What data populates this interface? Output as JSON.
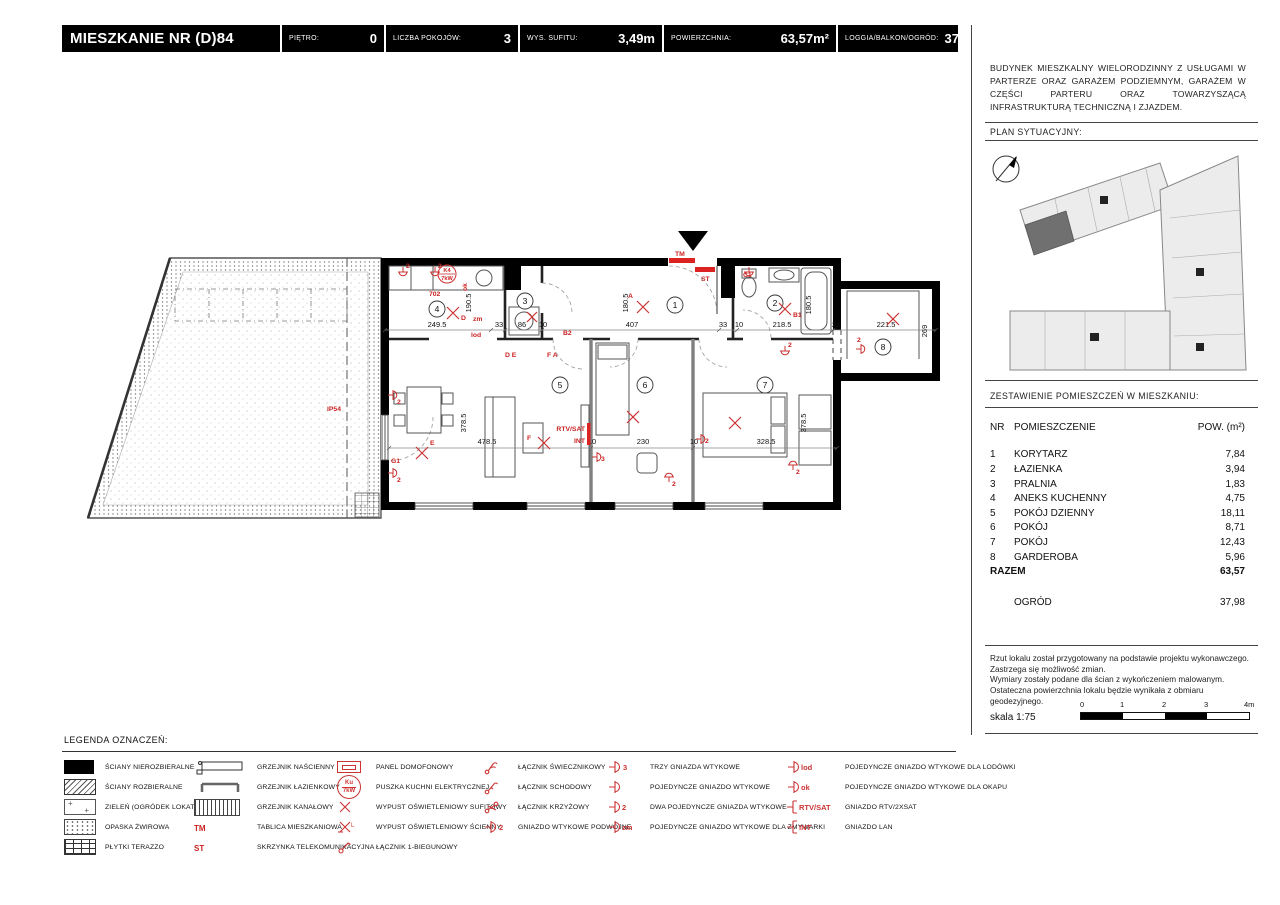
{
  "header": {
    "title": "MIESZKANIE NR (D)84",
    "fields": [
      {
        "label": "PIĘTRO:",
        "value": "0"
      },
      {
        "label": "LICZBA POKOJÓW:",
        "value": "3"
      },
      {
        "label": "WYS. SUFITU:",
        "value": "3,49m"
      },
      {
        "label": "POWIERZCHNIA:",
        "value": "63,57m²"
      },
      {
        "label": "LOGGIA/BALKON/OGRÓD:",
        "value": "37,98m²"
      }
    ]
  },
  "sidebar": {
    "description": "BUDYNEK MIESZKALNY WIELORODZINNY Z USŁUGAMI W PARTERZE ORAZ GARAŻEM PODZIEMNYM, GARAŻEM W CZĘŚCI PARTERU ORAZ TOWARZYSZĄCĄ INFRASTRUKTURĄ TECHNICZNĄ I ZJAZDEM.",
    "plan_sytuacyjny_label": "PLAN SYTUACYJNY:",
    "table_title": "ZESTAWIENIE POMIESZCZEŃ W MIESZKANIU:",
    "table": {
      "col_nr": "NR",
      "col_name": "POMIESZCZENIE",
      "col_area": "POW. (m²)",
      "rows": [
        {
          "nr": "1",
          "name": "KORYTARZ",
          "area": "7,84"
        },
        {
          "nr": "2",
          "name": "ŁAZIENKA",
          "area": "3,94"
        },
        {
          "nr": "3",
          "name": "PRALNIA",
          "area": "1,83"
        },
        {
          "nr": "4",
          "name": "ANEKS KUCHENNY",
          "area": "4,75"
        },
        {
          "nr": "5",
          "name": "POKÓJ DZIENNY",
          "area": "18,11"
        },
        {
          "nr": "6",
          "name": "POKÓJ",
          "area": "8,71"
        },
        {
          "nr": "7",
          "name": "POKÓJ",
          "area": "12,43"
        },
        {
          "nr": "8",
          "name": "GARDEROBA",
          "area": "5,96"
        }
      ],
      "total_label": "RAZEM",
      "total": "63,57",
      "garden_label": "OGRÓD",
      "garden": "37,98"
    },
    "disclaimer": [
      "Rzut lokalu został przygotowany na podstawie projektu wykonawczego.",
      "Zastrzega się możliwość zmian.",
      "Wymiary zostały podane dla ścian z wykończeniem malowanym.",
      "Ostateczna powierzchnia lokalu będzie wynikała z obmiaru",
      "geodezyjnego."
    ],
    "scale_label": "skala 1:75",
    "scale_ticks": [
      "0",
      "1",
      "2",
      "3",
      "4m"
    ]
  },
  "plan": {
    "rooms": [
      "1",
      "2",
      "3",
      "4",
      "5",
      "6",
      "7",
      "8"
    ],
    "dims_top": [
      "249.5",
      "33",
      "86",
      "10",
      "407",
      "33",
      "10",
      "218.5",
      "21",
      "221.5"
    ],
    "dims_side": [
      "190.5",
      "180.5",
      "180.5",
      "269"
    ],
    "dims_bottom": [
      "478.5",
      "10",
      "230",
      "10",
      "328.5"
    ],
    "dims_side2": [
      "378.5",
      "378.5"
    ],
    "marks": {
      "tm": "TM",
      "st": "ST",
      "rtvsat": "RTV/SAT",
      "int": "INT",
      "ip54": "IP54",
      "n702": "702",
      "k4": "K4",
      "kw": "7kW",
      "ok": "ok",
      "zm": "zm",
      "lod": "lod",
      "de": "D E",
      "fa": "F A",
      "b1": "B1",
      "b2": "B2",
      "c1": "C1",
      "g1": "G1",
      "a": "A",
      "d": "D",
      "e": "E",
      "f": "F",
      "s2": "2",
      "s3": "3"
    }
  },
  "legend": {
    "title": "LEGENDA OZNACZEŃ:",
    "items": [
      {
        "label": "ŚCIANY NIEROZBIERALNE"
      },
      {
        "label": "ŚCIANY ROZBIERALNE"
      },
      {
        "label": "ZIELEŃ (OGRÓDEK LOKATORSKI)"
      },
      {
        "label": "OPASKA ŻWIROWA"
      },
      {
        "label": "PŁYTKI TERAZZO"
      },
      {
        "label": "GRZEJNIK NAŚCIENNY"
      },
      {
        "label": "GRZEJNIK ŁAZIENKOWY"
      },
      {
        "label": "GRZEJNIK KANAŁOWY"
      },
      {
        "label": "TABLICA MIESZKANIOWA",
        "code": "TM"
      },
      {
        "label": "SKRZYNKA TELEKOMUNIKACYJNA",
        "code": "ST"
      },
      {
        "label": "PANEL DOMOFONOWY"
      },
      {
        "label": "PUSZKA KUCHNI ELEKTRYCZNEJ",
        "code": "Ku",
        "code2": "7kW"
      },
      {
        "label": "WYPUST OŚWIETLENIOWY SUFITOWY"
      },
      {
        "label": "WYPUST OŚWIETLENIOWY ŚCIENNY"
      },
      {
        "label": "ŁĄCZNIK 1-BIEGUNOWY"
      },
      {
        "label": "ŁĄCZNIK ŚWIECZNIKOWY"
      },
      {
        "label": "ŁĄCZNIK SCHODOWY"
      },
      {
        "label": "ŁĄCZNIK KRZYŻOWY"
      },
      {
        "label": "GNIAZDO WTYKOWE PODWÓJNE",
        "code": "2"
      },
      {
        "label": "TRZY GNIAZDA WTYKOWE",
        "code": "3"
      },
      {
        "label": "POJEDYNCZE GNIAZDO WTYKOWE"
      },
      {
        "label": "DWA POJEDYNCZE GNIAZDA WTYKOWE",
        "code": "2"
      },
      {
        "label": "POJEDYNCZE GNIAZDO WTYKOWE DLA ZMYWARKI",
        "code": "zm"
      },
      {
        "label": "POJEDYNCZE GNIAZDO WTYKOWE DLA LODÓWKI",
        "code": "lod"
      },
      {
        "label": "POJEDYNCZE GNIAZDO WTYKOWE DLA OKAPU",
        "code": "ok"
      },
      {
        "label": "GNIAZDO RTV/2XSAT",
        "code": "RTV/SAT"
      },
      {
        "label": "GNIAZDO LAN",
        "code": "INT"
      }
    ]
  },
  "colors": {
    "accent_red": "#cc2222",
    "wall_black": "#000000"
  }
}
